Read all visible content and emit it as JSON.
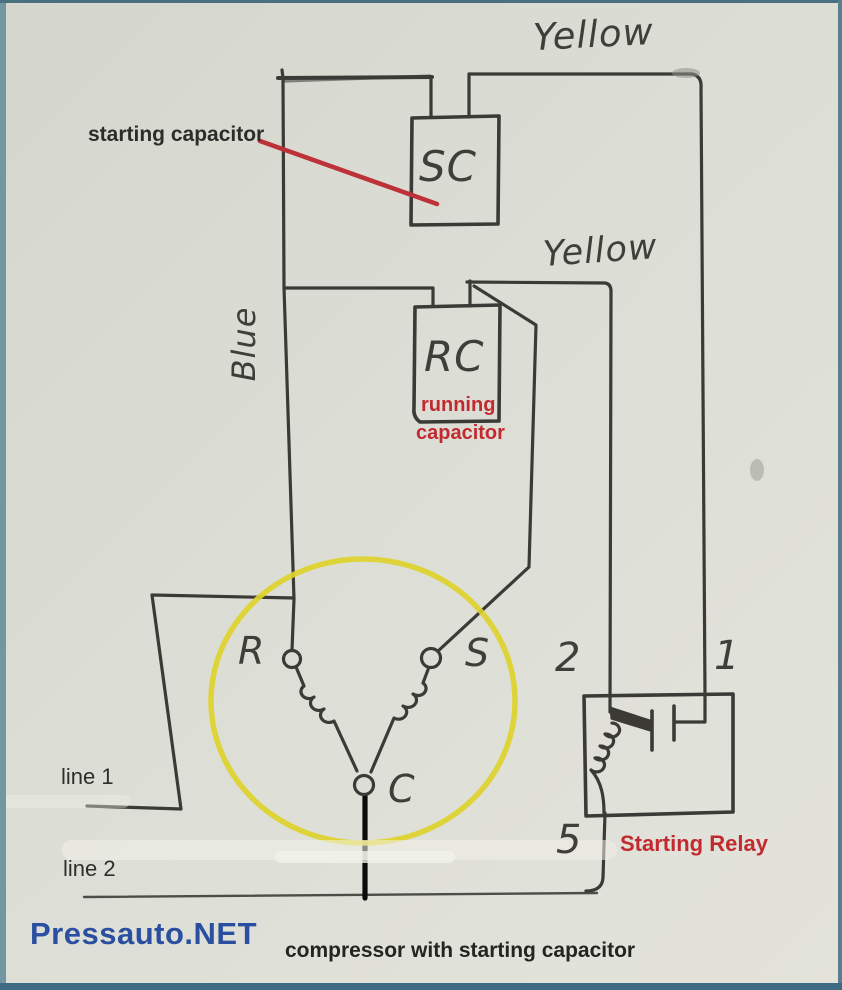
{
  "caption": {
    "text": "compressor with starting capacitor"
  },
  "watermark": {
    "text": "Pressauto.NET"
  },
  "callouts": {
    "starting_capacitor": "starting capacitor",
    "running_capacitor_line1": "running",
    "running_capacitor_line2": "capacitor",
    "starting_relay": "Starting Relay"
  },
  "wire_labels": {
    "yellow_top": "Yellow",
    "yellow_mid": "Yellow",
    "blue": "Blue"
  },
  "components": {
    "starting_capacitor": "SC",
    "running_capacitor": "RC",
    "motor_terminal_run": "R",
    "motor_terminal_start": "S",
    "motor_terminal_common": "C",
    "relay_terminal_2": "2",
    "relay_terminal_1": "1",
    "relay_terminal_5": "5"
  },
  "power": {
    "line1": "line 1",
    "line2": "line 2"
  },
  "colors": {
    "paper": "#dcded6",
    "ink": "#3b3a36",
    "accent_red": "#c22a30",
    "brand_blue": "#2b4fa0",
    "motor_circle_yellow": "#ddd22b"
  }
}
